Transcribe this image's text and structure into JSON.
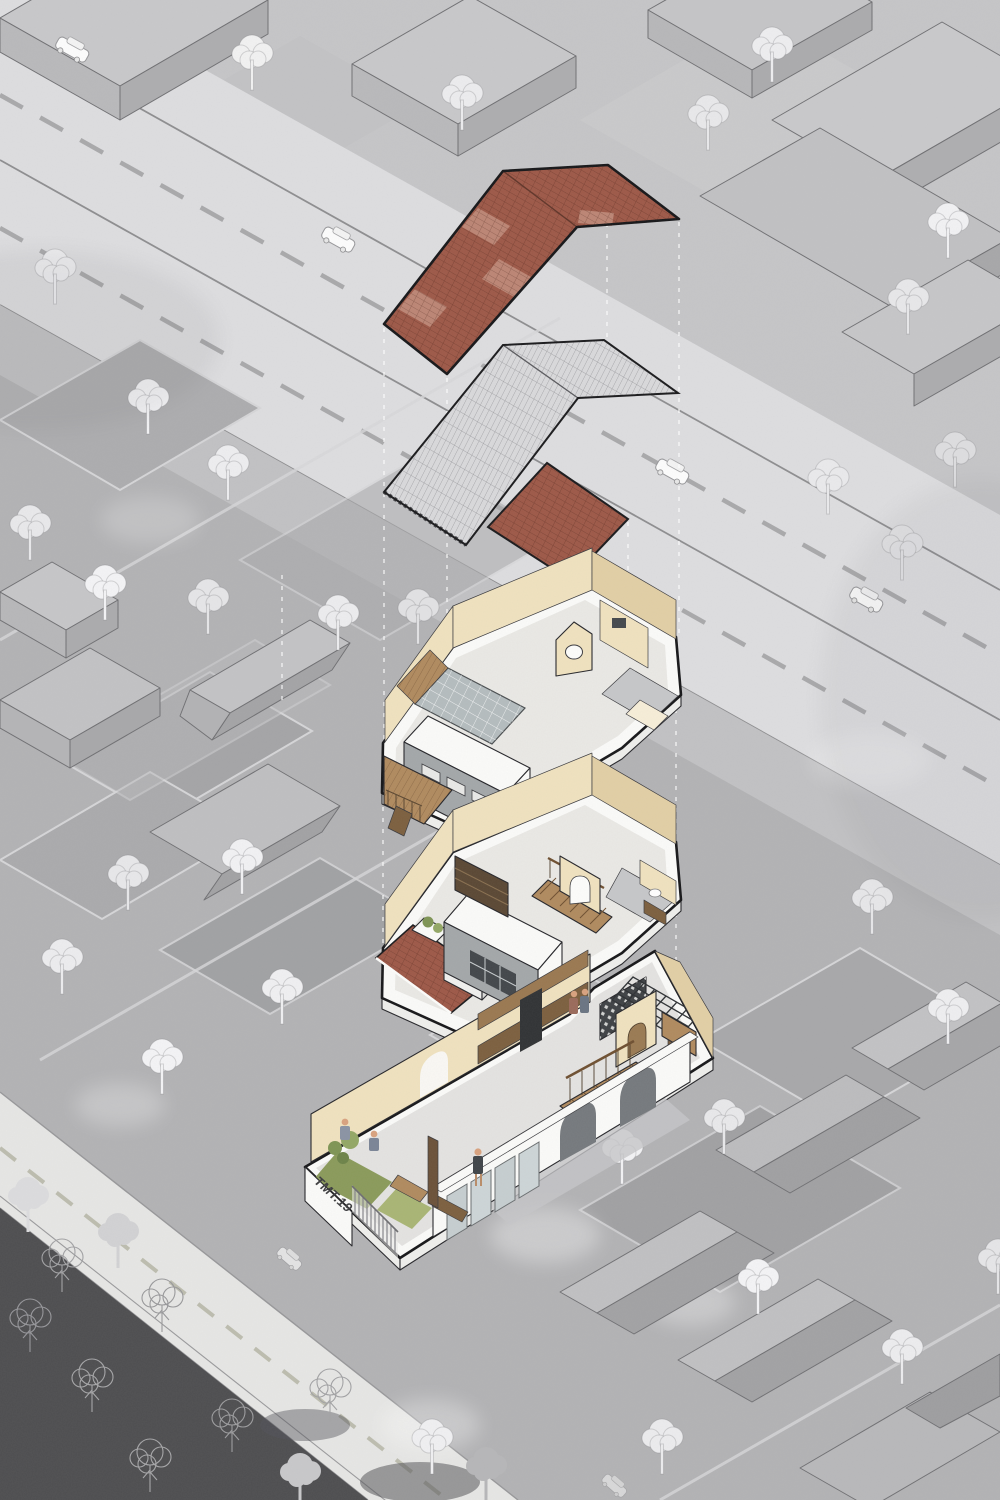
{
  "title": "Exploded axonometric diagram of townhouse TMT.19 on grayscale site plan",
  "label": {
    "house_name": "TMT.19"
  },
  "colors": {
    "background": "#c6c6c8",
    "road": "#dedee0",
    "side_road": "#e7e7e5",
    "sidewalk": "#c2c2c4",
    "plot_medium": "#b3b3b5",
    "park_dark": "#4e4e50",
    "tree_white": "#f2f2f2",
    "tree_outline": "#a2a2a4",
    "roof_red": "#9d5847",
    "roof_red_light": "#c28d7c",
    "roof_metal": "#d9d9db",
    "slab_white": "#fbfbf9",
    "wall_cream": "#f0e2bf",
    "wall_gray": "#a3a7a9",
    "glass": "#b4bcbe",
    "wood": "#b08a5e",
    "grass": "#8a9a5a",
    "grass_light": "#a9b574",
    "outline": "#161618"
  },
  "layers": [
    {
      "id": "main-roof",
      "name": "main pitched roof",
      "material": "red clay tiles with lighter skylight patches"
    },
    {
      "id": "metal-roof",
      "name": "secondary roof",
      "material": "corrugated metal sheet"
    },
    {
      "id": "canopy-roof",
      "name": "front canopy roof",
      "material": "red clay tiles"
    },
    {
      "id": "second-floor",
      "name": "second floor plan",
      "features": [
        "glazed atrium",
        "timber deck",
        "arched pavilion",
        "gable wall with round window",
        "bathroom wing"
      ]
    },
    {
      "id": "first-floor",
      "name": "first floor plan",
      "features": [
        "tiled lean-to roof",
        "planter boxes",
        "arched pavilion",
        "wardrobe",
        "staircase",
        "bathroom wing"
      ]
    },
    {
      "id": "ground-floor",
      "name": "ground floor plan",
      "features": [
        "front lawn and shrubs",
        "picket fence",
        "glazed arcade with arches",
        "kitchen cabinets",
        "breeze-block screen",
        "staircase",
        "pergola"
      ],
      "label": "TMT.19"
    }
  ],
  "site": {
    "main_road": "wide avenue with solid and dashed lane markings",
    "side_road": "side street with dashed centerline",
    "park": "dark tree-covered block",
    "cars_visible": 6
  }
}
